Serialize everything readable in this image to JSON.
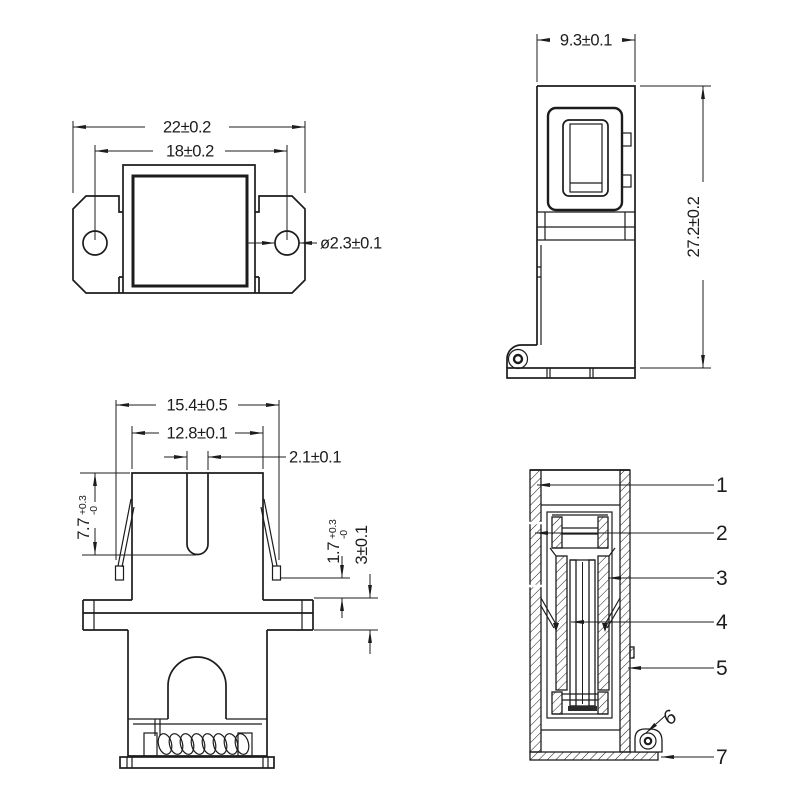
{
  "colors": {
    "line": "#1c1c1c",
    "background": "#ffffff"
  },
  "views": {
    "top": {
      "dims": {
        "outer_width": "22±0.2",
        "hole_spacing": "18±0.2",
        "hole_diameter": "ø2.3±0.1"
      }
    },
    "side": {
      "dims": {
        "width": "9.3±0.1",
        "height": "27.2±0.2"
      }
    },
    "front": {
      "dims": {
        "outer_width": "15.4±0.5",
        "inner_width": "12.8±0.1",
        "slot_width": "2.1±0.1",
        "latch_depth": {
          "value": "7.7",
          "tol_plus": "+0.3",
          "tol_minus": "-0"
        },
        "foot_to_flange": {
          "value": "1.7",
          "tol_plus": "+0.3",
          "tol_minus": "-0"
        },
        "flange_height": "3±0.1"
      }
    },
    "section": {
      "part_numbers": [
        "1",
        "2",
        "3",
        "4",
        "5",
        "6",
        "7"
      ]
    }
  }
}
